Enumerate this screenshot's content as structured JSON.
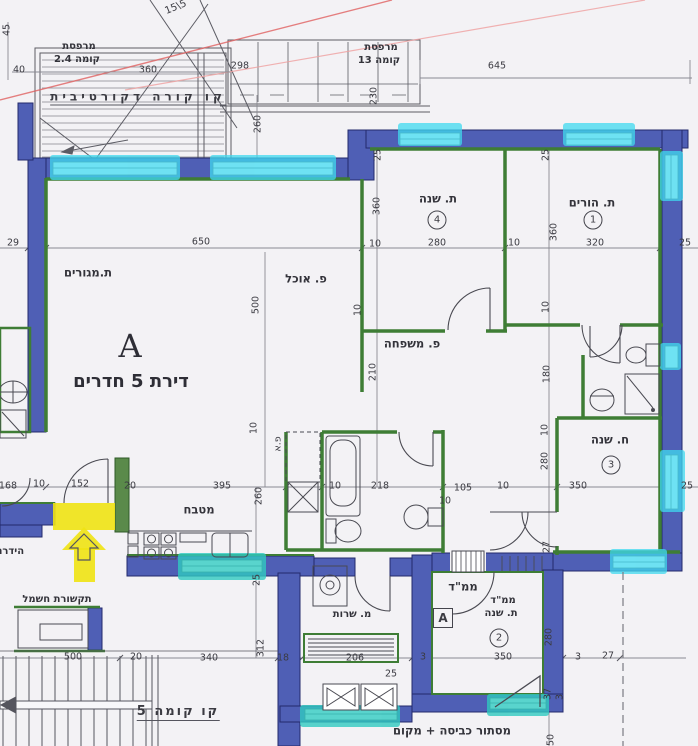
{
  "meta": {
    "drawing_type": "architectural floor plan (scanned blueprint)"
  },
  "colors": {
    "paper": "#f3f2f5",
    "wall": "#4f5fb5",
    "wall_dark": "#232a6b",
    "green": "#3e7d35",
    "cyan": "#3fd9ef",
    "teal": "#2fc9c0",
    "yellow": "#f0e313",
    "red": "#e06060",
    "red2": "#ef9f9f",
    "ink": "#3b3b42",
    "dimline": "#8a8a92"
  },
  "apartment": {
    "letter": "A",
    "title": "דירת 5 חדרים"
  },
  "rooms": [
    {
      "name": "ת.מגורים"
    },
    {
      "name": "פ. אוכל"
    },
    {
      "name": "פ. משפחה"
    },
    {
      "name": "מטבח"
    },
    {
      "name": "ת. שנה",
      "number": "4"
    },
    {
      "name": "ת. הורים",
      "number": "1"
    },
    {
      "name": "ח. שנה",
      "number": "3"
    },
    {
      "name": "ממ\"ד ת. שנה",
      "number": "2"
    },
    {
      "name": "מ. שרות"
    },
    {
      "name": "מרפסת קומה 2.4"
    },
    {
      "name": "מרפסת קומה 13"
    }
  ],
  "labels": [
    {
      "t": "15\\5",
      "x": 176,
      "y": 8,
      "c": "tilt"
    },
    {
      "t": "45",
      "x": 7,
      "y": 30,
      "c": "dimv"
    },
    {
      "t": "40",
      "x": 19,
      "y": 70,
      "c": "dim"
    },
    {
      "t": "מרפסת",
      "x": 79,
      "y": 47,
      "c": "room-sm"
    },
    {
      "t": "קומה 2.4",
      "x": 77,
      "y": 60,
      "c": "room-sm"
    },
    {
      "t": "360",
      "x": 148,
      "y": 70,
      "c": "dim"
    },
    {
      "t": "298",
      "x": 240,
      "y": 66,
      "c": "dim"
    },
    {
      "t": "מרפסת",
      "x": 381,
      "y": 48,
      "c": "room-sm"
    },
    {
      "t": "קומה 13",
      "x": 379,
      "y": 61,
      "c": "room-sm"
    },
    {
      "t": "645",
      "x": 497,
      "y": 66,
      "c": "dim"
    },
    {
      "t": "קו קורה דקורטיבית",
      "x": 138,
      "y": 98,
      "c": "deco"
    },
    {
      "t": "260",
      "x": 258,
      "y": 124,
      "c": "dimv"
    },
    {
      "t": "230",
      "x": 374,
      "y": 96,
      "c": "dimv"
    },
    {
      "t": "25",
      "x": 378,
      "y": 155,
      "c": "dimv"
    },
    {
      "t": "25",
      "x": 546,
      "y": 155,
      "c": "dimv"
    },
    {
      "t": "ת. שנה",
      "x": 438,
      "y": 199,
      "c": "room"
    },
    {
      "t": "4",
      "x": 437,
      "y": 220,
      "c": "circle"
    },
    {
      "t": "ת. הורים",
      "x": 592,
      "y": 203,
      "c": "room"
    },
    {
      "t": "1",
      "x": 593,
      "y": 220,
      "c": "circle"
    },
    {
      "t": "360",
      "x": 377,
      "y": 206,
      "c": "dimv"
    },
    {
      "t": "360",
      "x": 554,
      "y": 232,
      "c": "dimv"
    },
    {
      "t": "29",
      "x": 13,
      "y": 243,
      "c": "dim"
    },
    {
      "t": "650",
      "x": 201,
      "y": 242,
      "c": "dim"
    },
    {
      "t": "10",
      "x": 375,
      "y": 244,
      "c": "dim"
    },
    {
      "t": "280",
      "x": 437,
      "y": 243,
      "c": "dim"
    },
    {
      "t": "10",
      "x": 514,
      "y": 243,
      "c": "dim"
    },
    {
      "t": "320",
      "x": 595,
      "y": 243,
      "c": "dim"
    },
    {
      "t": "25",
      "x": 685,
      "y": 243,
      "c": "dim"
    },
    {
      "t": "ת.מגורים",
      "x": 88,
      "y": 273,
      "c": "room"
    },
    {
      "t": "פ. אוכל",
      "x": 306,
      "y": 279,
      "c": "room"
    },
    {
      "t": "500",
      "x": 256,
      "y": 305,
      "c": "dimv"
    },
    {
      "t": "10",
      "x": 358,
      "y": 310,
      "c": "dimv"
    },
    {
      "t": "10",
      "x": 546,
      "y": 307,
      "c": "dimv"
    },
    {
      "t": "פ. משפחה",
      "x": 412,
      "y": 344,
      "c": "room"
    },
    {
      "t": "210",
      "x": 373,
      "y": 372,
      "c": "dimv"
    },
    {
      "t": "180",
      "x": 547,
      "y": 374,
      "c": "dimv"
    },
    {
      "t": "10",
      "x": 545,
      "y": 430,
      "c": "dimv"
    },
    {
      "t": "280",
      "x": 545,
      "y": 461,
      "c": "dimv"
    },
    {
      "t": "ח. שנה",
      "x": 610,
      "y": 440,
      "c": "room"
    },
    {
      "t": "3",
      "x": 611,
      "y": 465,
      "c": "circle"
    },
    {
      "t": "168",
      "x": 8,
      "y": 486,
      "c": "dim"
    },
    {
      "t": "10",
      "x": 39,
      "y": 484,
      "c": "dim"
    },
    {
      "t": "152",
      "x": 80,
      "y": 484,
      "c": "dim"
    },
    {
      "t": "20",
      "x": 130,
      "y": 486,
      "c": "dim"
    },
    {
      "t": "395",
      "x": 222,
      "y": 486,
      "c": "dim"
    },
    {
      "t": "10",
      "x": 254,
      "y": 428,
      "c": "dimv"
    },
    {
      "t": "260",
      "x": 259,
      "y": 496,
      "c": "dimv"
    },
    {
      "t": "10",
      "x": 335,
      "y": 486,
      "c": "dim"
    },
    {
      "t": "218",
      "x": 380,
      "y": 486,
      "c": "dim"
    },
    {
      "t": "10",
      "x": 445,
      "y": 501,
      "c": "dim"
    },
    {
      "t": "105",
      "x": 463,
      "y": 488,
      "c": "dim"
    },
    {
      "t": "10",
      "x": 503,
      "y": 486,
      "c": "dim"
    },
    {
      "t": "350",
      "x": 578,
      "y": 486,
      "c": "dim"
    },
    {
      "t": "25",
      "x": 687,
      "y": 486,
      "c": "dim"
    },
    {
      "t": "מטבח",
      "x": 199,
      "y": 510,
      "c": "room"
    },
    {
      "t": "פ.א",
      "x": 278,
      "y": 444,
      "c": "dimv"
    },
    {
      "t": "25",
      "x": 257,
      "y": 580,
      "c": "dimv"
    },
    {
      "t": "הידרנ",
      "x": 11,
      "y": 552,
      "c": "room-sm"
    },
    {
      "t": "תקשורת חשמל",
      "x": 57,
      "y": 600,
      "c": "room-sm"
    },
    {
      "t": "מ. שרות",
      "x": 352,
      "y": 615,
      "c": "room-sm"
    },
    {
      "t": "ממ\"ד",
      "x": 463,
      "y": 587,
      "c": "room"
    },
    {
      "t": "A",
      "x": 443,
      "y": 618,
      "c": "boxed"
    },
    {
      "t": "ממ\"ד",
      "x": 503,
      "y": 601,
      "c": "room-sm"
    },
    {
      "t": "ת. שנה",
      "x": 501,
      "y": 614,
      "c": "room-sm"
    },
    {
      "t": "2",
      "x": 499,
      "y": 638,
      "c": "circle"
    },
    {
      "t": "500",
      "x": 73,
      "y": 657,
      "c": "dim"
    },
    {
      "t": "20",
      "x": 136,
      "y": 657,
      "c": "dim"
    },
    {
      "t": "340",
      "x": 209,
      "y": 658,
      "c": "dim"
    },
    {
      "t": "312",
      "x": 261,
      "y": 648,
      "c": "dimv"
    },
    {
      "t": "18",
      "x": 283,
      "y": 658,
      "c": "dim"
    },
    {
      "t": "206",
      "x": 355,
      "y": 658,
      "c": "dim"
    },
    {
      "t": "25",
      "x": 391,
      "y": 674,
      "c": "dim"
    },
    {
      "t": "3",
      "x": 423,
      "y": 657,
      "c": "dim"
    },
    {
      "t": "350",
      "x": 503,
      "y": 657,
      "c": "dim"
    },
    {
      "t": "3",
      "x": 578,
      "y": 657,
      "c": "dim"
    },
    {
      "t": "27",
      "x": 608,
      "y": 656,
      "c": "dim"
    },
    {
      "t": "280",
      "x": 549,
      "y": 637,
      "c": "dimv"
    },
    {
      "t": "27",
      "x": 547,
      "y": 547,
      "c": "dimv"
    },
    {
      "t": "37",
      "x": 548,
      "y": 694,
      "c": "dimv"
    },
    {
      "t": "3",
      "x": 560,
      "y": 697,
      "c": "dimv"
    },
    {
      "t": "50",
      "x": 551,
      "y": 740,
      "c": "dimv"
    },
    {
      "t": "קו קומה 5",
      "x": 178,
      "y": 713,
      "c": "deco2"
    },
    {
      "t": "מסתור כביסה + מקום",
      "x": 452,
      "y": 731,
      "c": "room"
    }
  ]
}
